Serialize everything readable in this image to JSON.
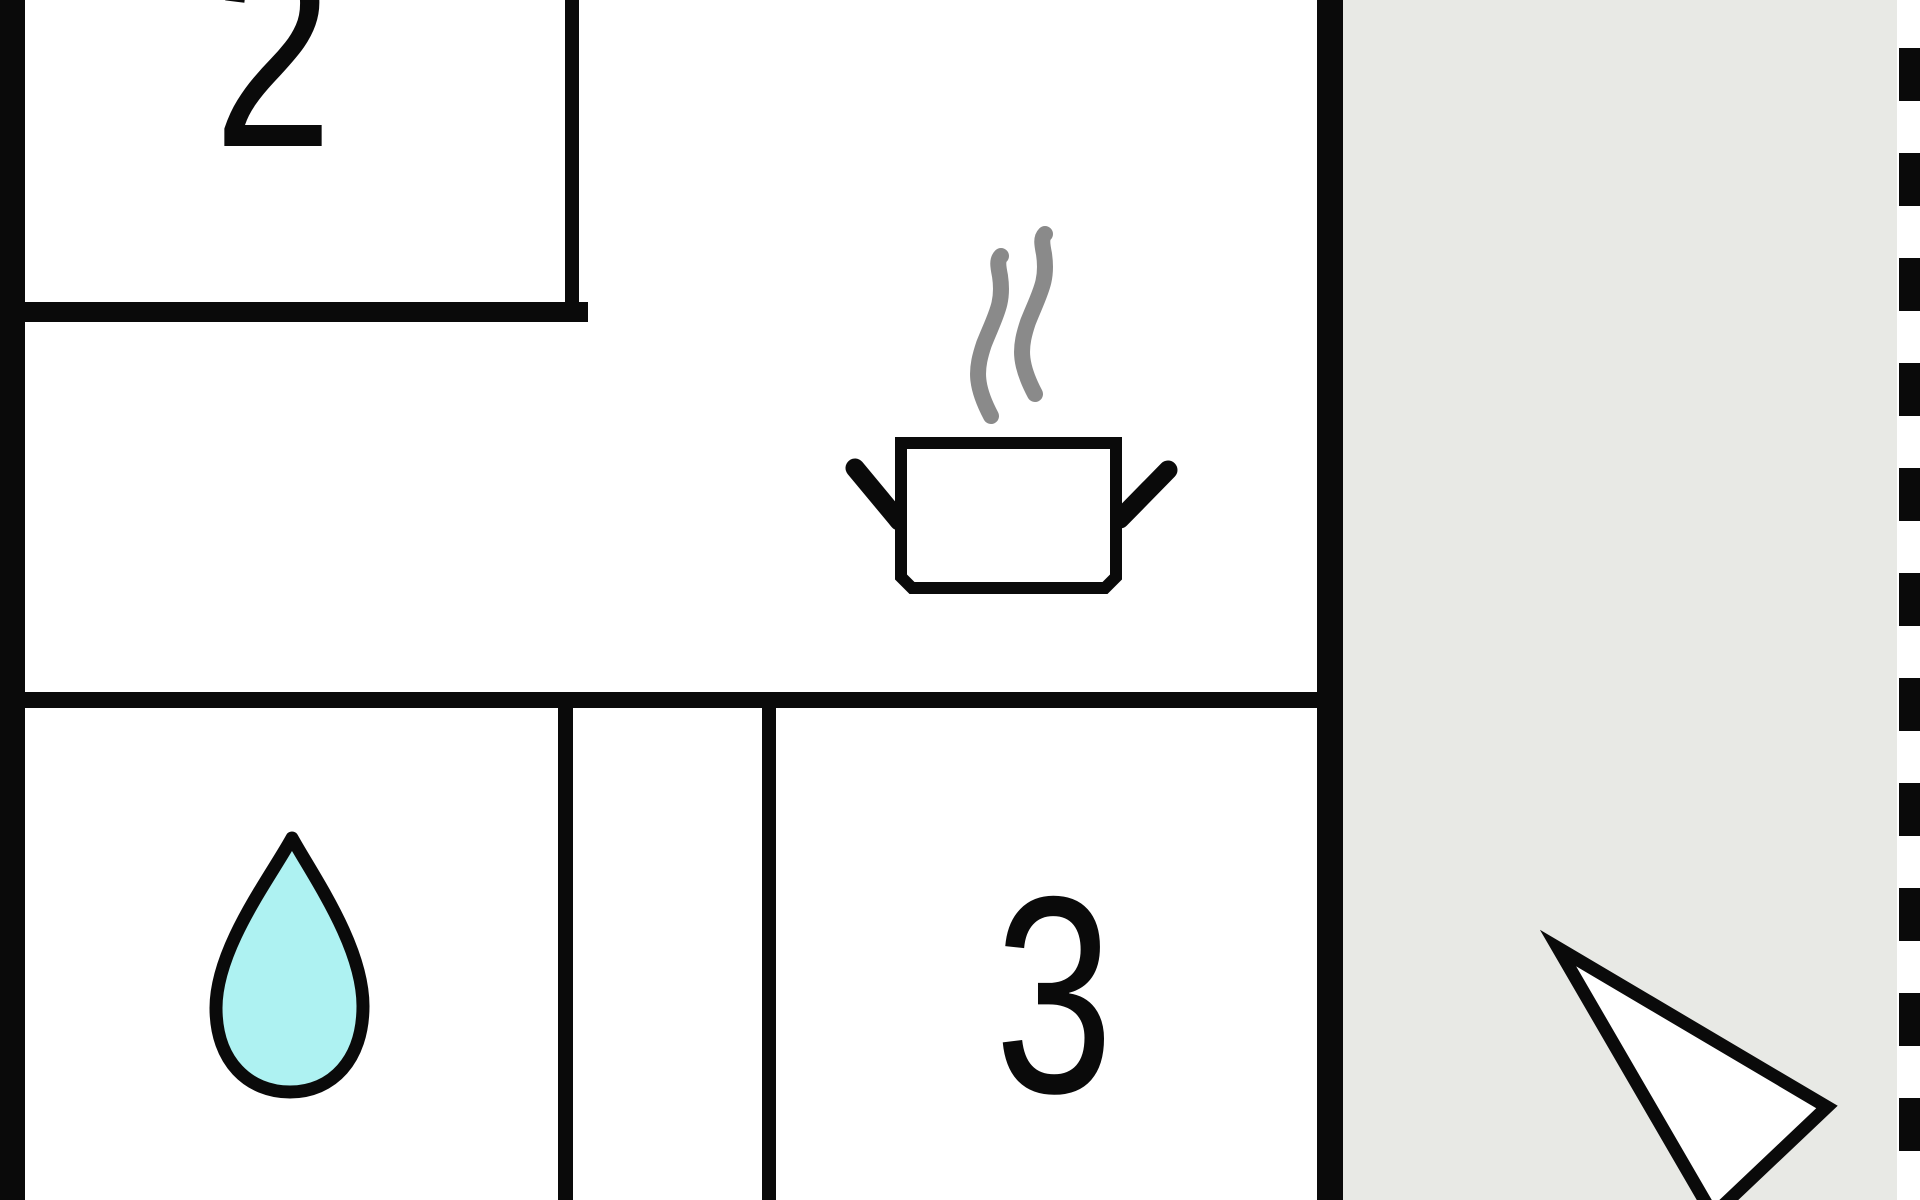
{
  "floor_plan": {
    "room_labels": {
      "room_2": "2",
      "room_3": "3"
    },
    "icons": {
      "steam": "steam-icon",
      "cooking_pot": "cooking-pot-icon",
      "water_drop": "water-drop-icon",
      "north_arrow": "north-arrow-icon"
    },
    "colors": {
      "wall": "#0a0a0a",
      "floor": "#ffffff",
      "terrace": "#e8e9e5",
      "steam": "#8a8a8a",
      "water_drop_fill": "#aef2f2",
      "arrow_fill": "#ffffff"
    }
  }
}
